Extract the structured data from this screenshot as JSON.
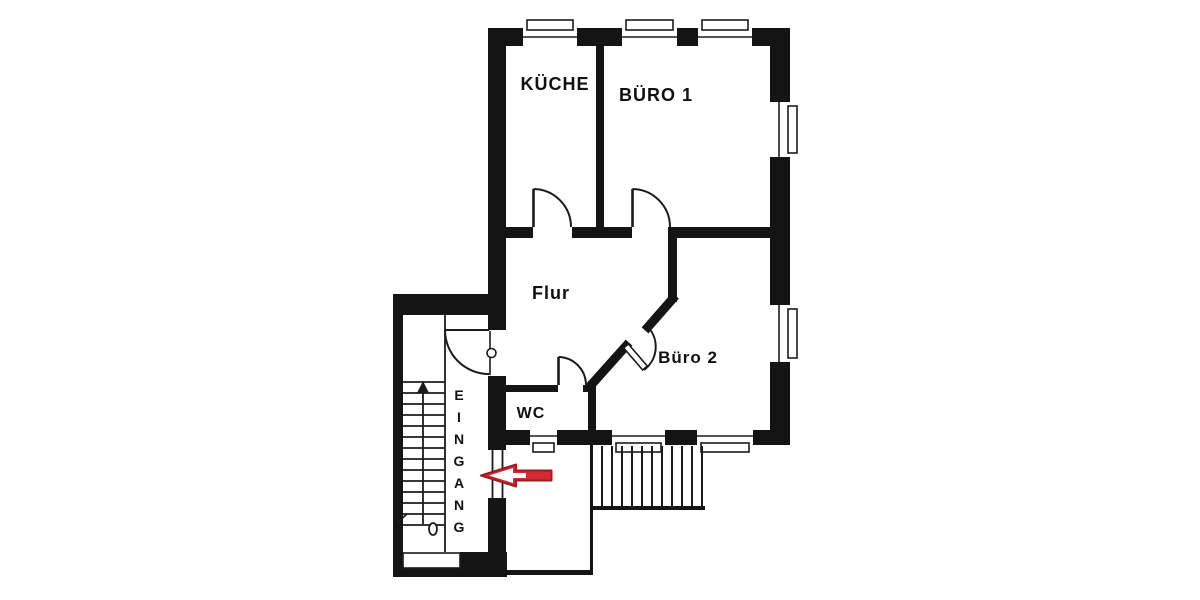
{
  "plan": {
    "kind": "floor-plan",
    "rooms": {
      "kueche": {
        "label": "KÜCHE"
      },
      "buero1": {
        "label": "BÜRO 1"
      },
      "flur": {
        "label": "Flur"
      },
      "buero2": {
        "label": "Büro 2"
      },
      "wc": {
        "label": "WC"
      },
      "eingang": {
        "label": "EINGANG",
        "letters": [
          "E",
          "I",
          "N",
          "G",
          "A",
          "N",
          "G"
        ]
      }
    },
    "colors": {
      "wall": "#141414",
      "line": "#1b1b1b",
      "text": "#111111",
      "background": "#ffffff",
      "arrow": "#d22a32",
      "arrow_outline": "#9e1b21",
      "arrow_inner": "#ffffff"
    }
  }
}
